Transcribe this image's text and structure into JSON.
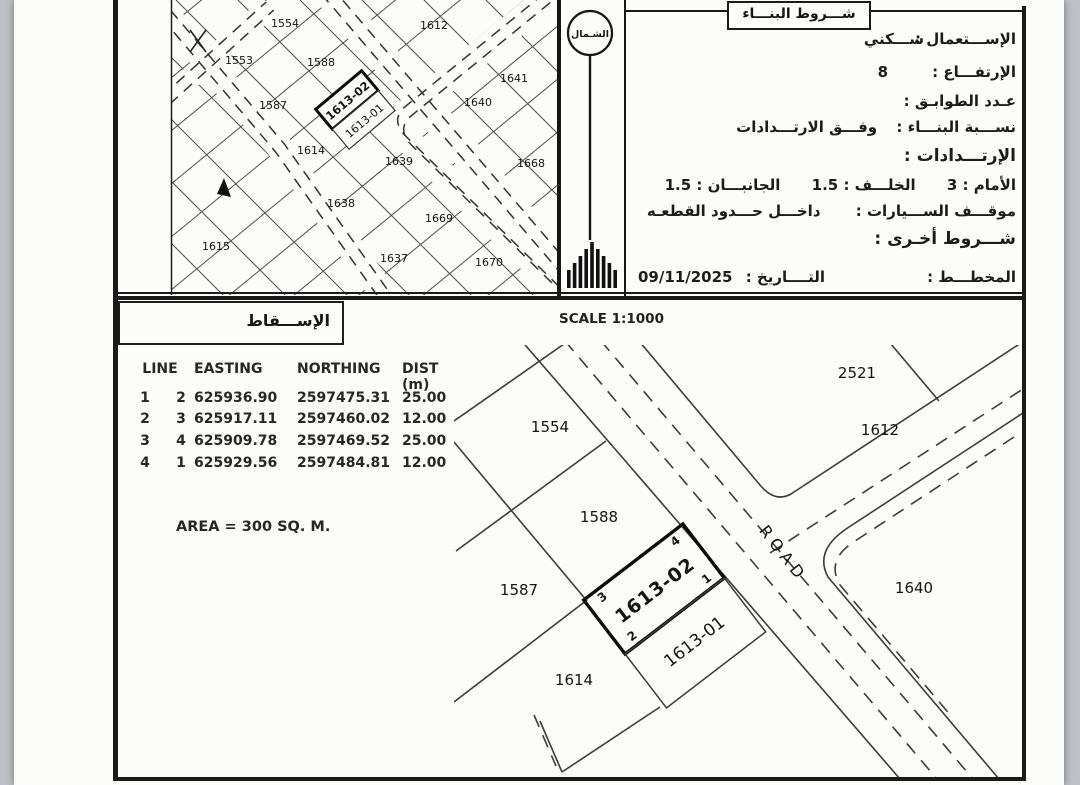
{
  "document": {
    "conditions_panel": {
      "header": "شـــروط البنـــاء",
      "rows": [
        {
          "label": "الإســـتعمال :",
          "value": "ســـكني"
        },
        {
          "label": "الإرتفـــاع :",
          "value": "8"
        },
        {
          "label": "عـدد الطوابـق :",
          "value": ""
        },
        {
          "label": "نســـبة البنـــاء :",
          "value": "وفـــق الارتـــدادات"
        },
        {
          "label": "الإرتـــدادات :",
          "value": ""
        },
        {
          "label": "موقـــف الســـيارات :",
          "value": "داخـــل حـــدود القطعـه"
        },
        {
          "label": "شـــروط أخـرى :",
          "value": ""
        }
      ],
      "setbacks": {
        "front_label": "الأمام :",
        "front_value": "3",
        "back_label": "الخلـــف :",
        "back_value": "1.5",
        "sides_label": "الجانبـــان :",
        "sides_value": "1.5"
      },
      "plan_label": "المخطـــط :",
      "date_label": "التــــاريخ :",
      "date_value": "09/11/2025"
    },
    "north_panel": {
      "north_label": "الشـمال"
    },
    "overview_map": {
      "plots": [
        "1554",
        "1553",
        "1588",
        "1612",
        "1641",
        "1587",
        "1640",
        "1614",
        "1639",
        "1668",
        "1638",
        "1669",
        "1615",
        "1637",
        "1670"
      ],
      "highlight_plot": "1613-02",
      "adjacent_plot": "1613-01"
    },
    "projection_panel": {
      "header": "الإســـقاط",
      "scale": "SCALE 1:1000",
      "table": {
        "headers": [
          "LINE",
          "EASTING",
          "NORTHING",
          "DIST (m)"
        ],
        "rows": [
          [
            "1",
            "2",
            "625936.90",
            "2597475.31",
            "25.00"
          ],
          [
            "2",
            "3",
            "625917.11",
            "2597460.02",
            "12.00"
          ],
          [
            "3",
            "4",
            "625909.78",
            "2597469.52",
            "25.00"
          ],
          [
            "4",
            "1",
            "625929.56",
            "2597484.81",
            "12.00"
          ]
        ]
      },
      "area": "AREA = 300 SQ. M.",
      "detail_map": {
        "plots": [
          "2521",
          "1612",
          "1554",
          "1588",
          "1587",
          "1614",
          "1640"
        ],
        "highlight_plot": "1613-02",
        "adjacent_plot": "1613-01",
        "road_label": "ROAD",
        "corners": [
          "1",
          "2",
          "3",
          "4"
        ]
      }
    }
  }
}
